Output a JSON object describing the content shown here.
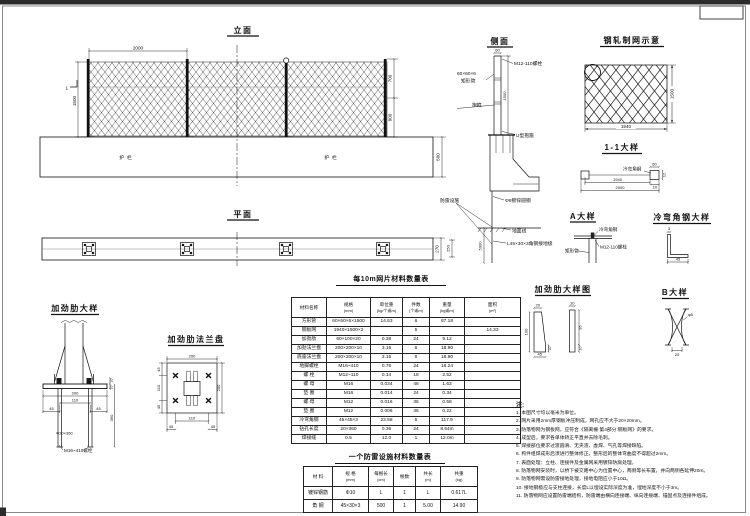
{
  "elev": {
    "title": "立面",
    "dim_top": "2000",
    "dim_left": "1500",
    "sec_mark": "1",
    "dim_r_upper": "700",
    "dim_r_lower": "800",
    "dim_base_h": "500",
    "guard_left": "护栏",
    "guard_right": "护栏"
  },
  "plan": {
    "title": "平面",
    "dim_h": "270"
  },
  "side": {
    "title": "侧面",
    "dim_top": "60",
    "lbl_bolt": "M12-110螺栓",
    "lbl_tube_size": "60×60×6",
    "lbl_tube": "矩形管",
    "lbl_clamp": "抱箍",
    "dim_post": "1500",
    "lbl_uclamp": "U型抱箍",
    "lbl_rod": "Φ8镀锌圆钢",
    "lbl_ground": "地面线",
    "lbl_angle": "L45×30×3角钢接地极",
    "lbl_lightning": "防雷设施",
    "dim_depth": "5000",
    "dim_stub": "250"
  },
  "meshfig": {
    "title": "钢轧制网示意",
    "dim_w": "1940",
    "dim_h": "1500"
  },
  "sec11": {
    "title": "1-1大样",
    "lbl_angle": "冷弯角钢",
    "dim_1940": "1940",
    "dim_2000": "2000",
    "dim_60": "60",
    "dim_12": "12",
    "dim_10": "10"
  },
  "detA": {
    "title": "A大样",
    "lbl_angle": "冷弯角钢",
    "lbl_bolt": "M12-110螺栓",
    "lbl_tube": "矩形管"
  },
  "detAngle": {
    "title": "冷弯角钢大样",
    "dim_45": "45",
    "dim_3": "3"
  },
  "rib": {
    "title": "加劲肋大样",
    "dim_200": "200",
    "dim_110": "110",
    "dim_45a": "45",
    "dim_45b": "45",
    "dim_10a": "10",
    "dim_10b": "10",
    "dim_360": "360",
    "lbl_hole": "Φ20×360",
    "lbl_bolt": "M16~410螺栓"
  },
  "ribplate": {
    "title": "加劲肋法兰盘",
    "dim_top": "200",
    "dim_l45a": "45",
    "dim_l110": "110",
    "dim_l45b": "45",
    "dim_r200": "200",
    "dim_b110": "110",
    "dim_b45a": "45",
    "dim_b45b": "45"
  },
  "ribfig": {
    "title": "加劲肋大样图",
    "dim_20": "20",
    "dim_100": "100",
    "dim_45": "45",
    "dim_10a": "10",
    "dim_10b": "10",
    "dim_95": "95",
    "dim_10c": "10"
  },
  "detB": {
    "title": "B大样",
    "dim_20": "20",
    "lbl_phi": "φ5"
  },
  "t1": {
    "title": "每10m网片材料数量表",
    "headers": [
      {
        "a": "材料名称",
        "b": ""
      },
      {
        "a": "规格",
        "b": "(mm)"
      },
      {
        "a": "单位重",
        "b": "(kg/个或m)"
      },
      {
        "a": "件数",
        "b": "(个或m)"
      },
      {
        "a": "重量",
        "b": "(kg或m)"
      },
      {
        "a": "面积",
        "b": "(m²)"
      }
    ],
    "rows": [
      [
        "方形管",
        "60×60×6×1500",
        "14.53",
        "6",
        "87.18",
        ""
      ],
      [
        "钢板网",
        "1940×1500×2",
        "",
        "5",
        "",
        "14.33"
      ],
      [
        "加劲肋",
        "60×100×20",
        "0.38",
        "24",
        "9.12",
        ""
      ],
      [
        "加劲法兰盘",
        "200×200×10",
        "3.15",
        "6",
        "18.90",
        ""
      ],
      [
        "底座法兰盘",
        "200×200×10",
        "3.15",
        "6",
        "18.90",
        ""
      ],
      [
        "地脚螺栓",
        "M16~410",
        "0.76",
        "24",
        "18.24",
        ""
      ],
      [
        "螺 栓",
        "M12~110",
        "0.14",
        "18",
        "2.52",
        ""
      ],
      [
        "螺 母",
        "M16",
        "0.034",
        "48",
        "1.63",
        ""
      ],
      [
        "垫 圈",
        "M16",
        "0.014",
        "24",
        "0.34",
        ""
      ],
      [
        "螺 母",
        "M12",
        "0.016",
        "36",
        "0.58",
        ""
      ],
      [
        "垫 圈",
        "M12",
        "0.006",
        "36",
        "0.22",
        ""
      ],
      [
        "冷弯角钢",
        "45×45×3",
        "23.58",
        "5",
        "117.9",
        ""
      ],
      [
        "钻孔长度",
        "20×360",
        "0.36",
        "24",
        "8.64m",
        ""
      ],
      [
        "焊接缝",
        "0.5",
        "12.0",
        "1",
        "12.0m",
        ""
      ]
    ]
  },
  "t2": {
    "title": "一个防雷设施材料数量表",
    "headers": [
      {
        "a": "材 料",
        "b": ""
      },
      {
        "a": "规 格",
        "b": "(mm)"
      },
      {
        "a": "每根长",
        "b": "(cm)"
      },
      {
        "a": "根数",
        "b": ""
      },
      {
        "a": "共长",
        "b": "(m)"
      },
      {
        "a": "共重",
        "b": "(kg)"
      }
    ],
    "rows": [
      [
        "镀锌钢筋",
        "Φ10",
        "L",
        "1",
        "L",
        "0.617L"
      ],
      [
        "角 钢",
        "45×30×3",
        "500",
        "1",
        "5.00",
        "14.90"
      ]
    ]
  },
  "notes": {
    "title": "注:",
    "items": [
      "1. 本图尺寸均以毫米为单位。",
      "2. 网片采用2mm厚钢板冲压制成，网孔应不大于20×20mm。",
      "3. 防落物网为钢板网，应符合《隔离栅 第4部分:钢板网》的要求。",
      "4. 成型后，要求各单体矫正平直并去除毛刺。",
      "5. 焊接部位要求过渡圆滑、无夹渣、虚焊、气孔等焊接缺陷。",
      "6. 构件组焊成形后须进行整体修正，整形后的整体弯曲度不得超过2mm。",
      "7. 表面处理：立柱、连接件及金属网采用镀锌防腐处理。",
      "8. 防落物网安装时，以桥下被交路中心为位置中心，两侧等长布置，并向两侧各延伸20m。",
      "9. 防落物网需设防雷接地处理，接地电阻应小于10Ω。",
      "10. 接地钢极应与支柱连接，长度L以埋设实际深度为准，埋地深度不小于3m。",
      "11. 防落物网应设置防雷端结构，防雷端由横向连接端、纵向连接端、锚固点及连接件组成。"
    ]
  }
}
